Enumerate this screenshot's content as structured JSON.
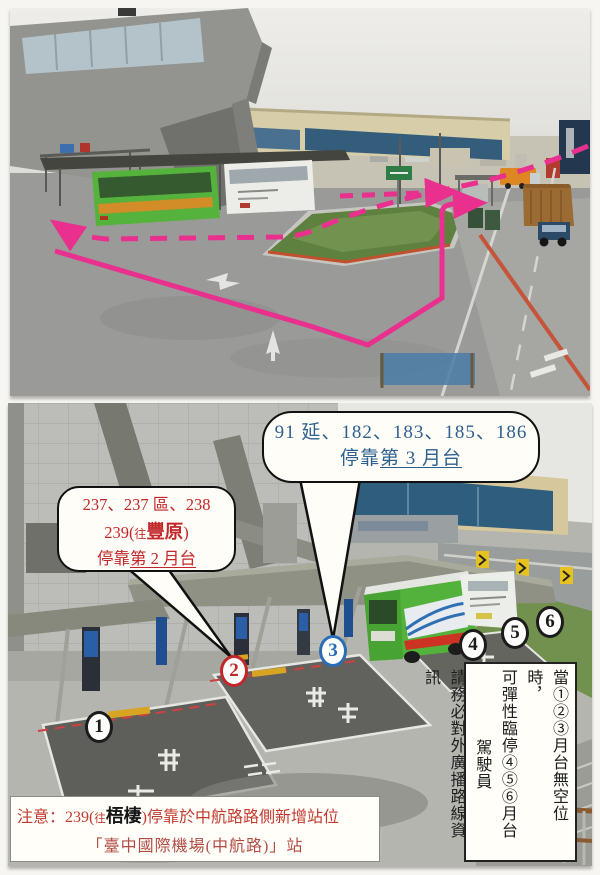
{
  "document": {
    "type": "scanned bus-platform notice with two annotated photos",
    "colors": {
      "route_pink": "#e9308e",
      "callout_blue_text": "#2e608e",
      "callout_red_text": "#c2272a",
      "notice_red": "#c23a30",
      "marker_blue": "#2a6db5",
      "marker_red": "#c0272a"
    }
  },
  "top_photo": {
    "description": "airport curbside loop road with green traffic island, buses, trucks and pink dashed/solid route arrows"
  },
  "bottom_photo": {
    "description": "bus bay platforms numbered 1-6 under canopies with a green bus"
  },
  "callout_blue": {
    "line1": "91 延、182、183、185、186",
    "line2_prefix": "停靠",
    "line2_underlined": "第 3 月台"
  },
  "callout_red": {
    "line1": "237、237 區、238",
    "line2_prefix": "239(",
    "line2_small": "往",
    "line2_bold": "豐原",
    "line2_suffix": ")",
    "line3_prefix": "停靠",
    "line3_underlined": "第 2 月台"
  },
  "platform_markers": [
    {
      "label": "1",
      "color": "black"
    },
    {
      "label": "2",
      "color": "red"
    },
    {
      "label": "3",
      "color": "blue"
    },
    {
      "label": "4",
      "color": "black"
    },
    {
      "label": "5",
      "color": "black"
    },
    {
      "label": "6",
      "color": "black"
    }
  ],
  "vertical_note": {
    "col1": "當①②③月台無空位時，",
    "col2": "可彈性臨停④⑤⑥月台",
    "col3": "駕駛員",
    "col4": "請務必對外廣播路線資訊"
  },
  "notice": {
    "line1_prefix": "注意：239(",
    "line1_small": "往",
    "line1_bold_black": "梧棲",
    "line1_suffix": ")停靠於中航路路側新增站位",
    "line2": "「臺中國際機場(中航路)」站"
  }
}
